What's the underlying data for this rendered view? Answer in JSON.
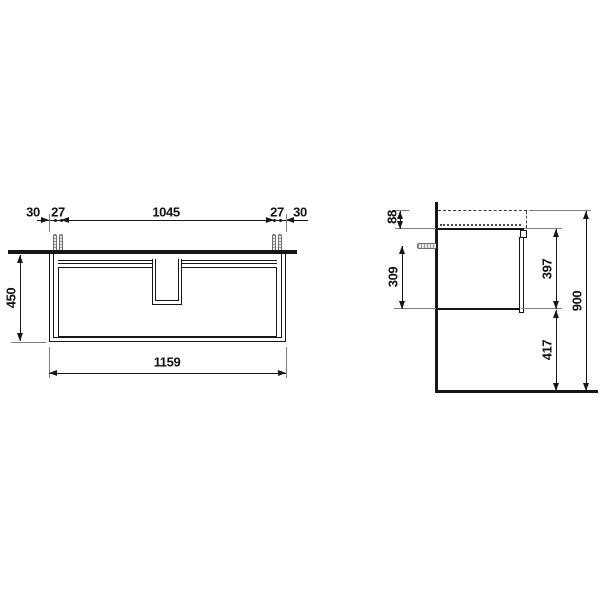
{
  "drawing": {
    "title": "vanity-unit-dimension-drawing",
    "front_view": {
      "dim_overhang_left": "30",
      "dim_fixing_offset_left": "27",
      "dim_fixing_span": "1045",
      "dim_fixing_offset_right": "27",
      "dim_overhang_right": "30",
      "dim_height": "450",
      "dim_width": "1159"
    },
    "side_view": {
      "dim_top_to_carcase": "88",
      "dim_fixing_to_bottom": "309",
      "dim_carcase_height": "397",
      "dim_bottom_to_floor": "417",
      "dim_total_height": "900"
    },
    "colors": {
      "line": "#161616",
      "extension_line": "#808080",
      "background": "#ffffff"
    }
  }
}
